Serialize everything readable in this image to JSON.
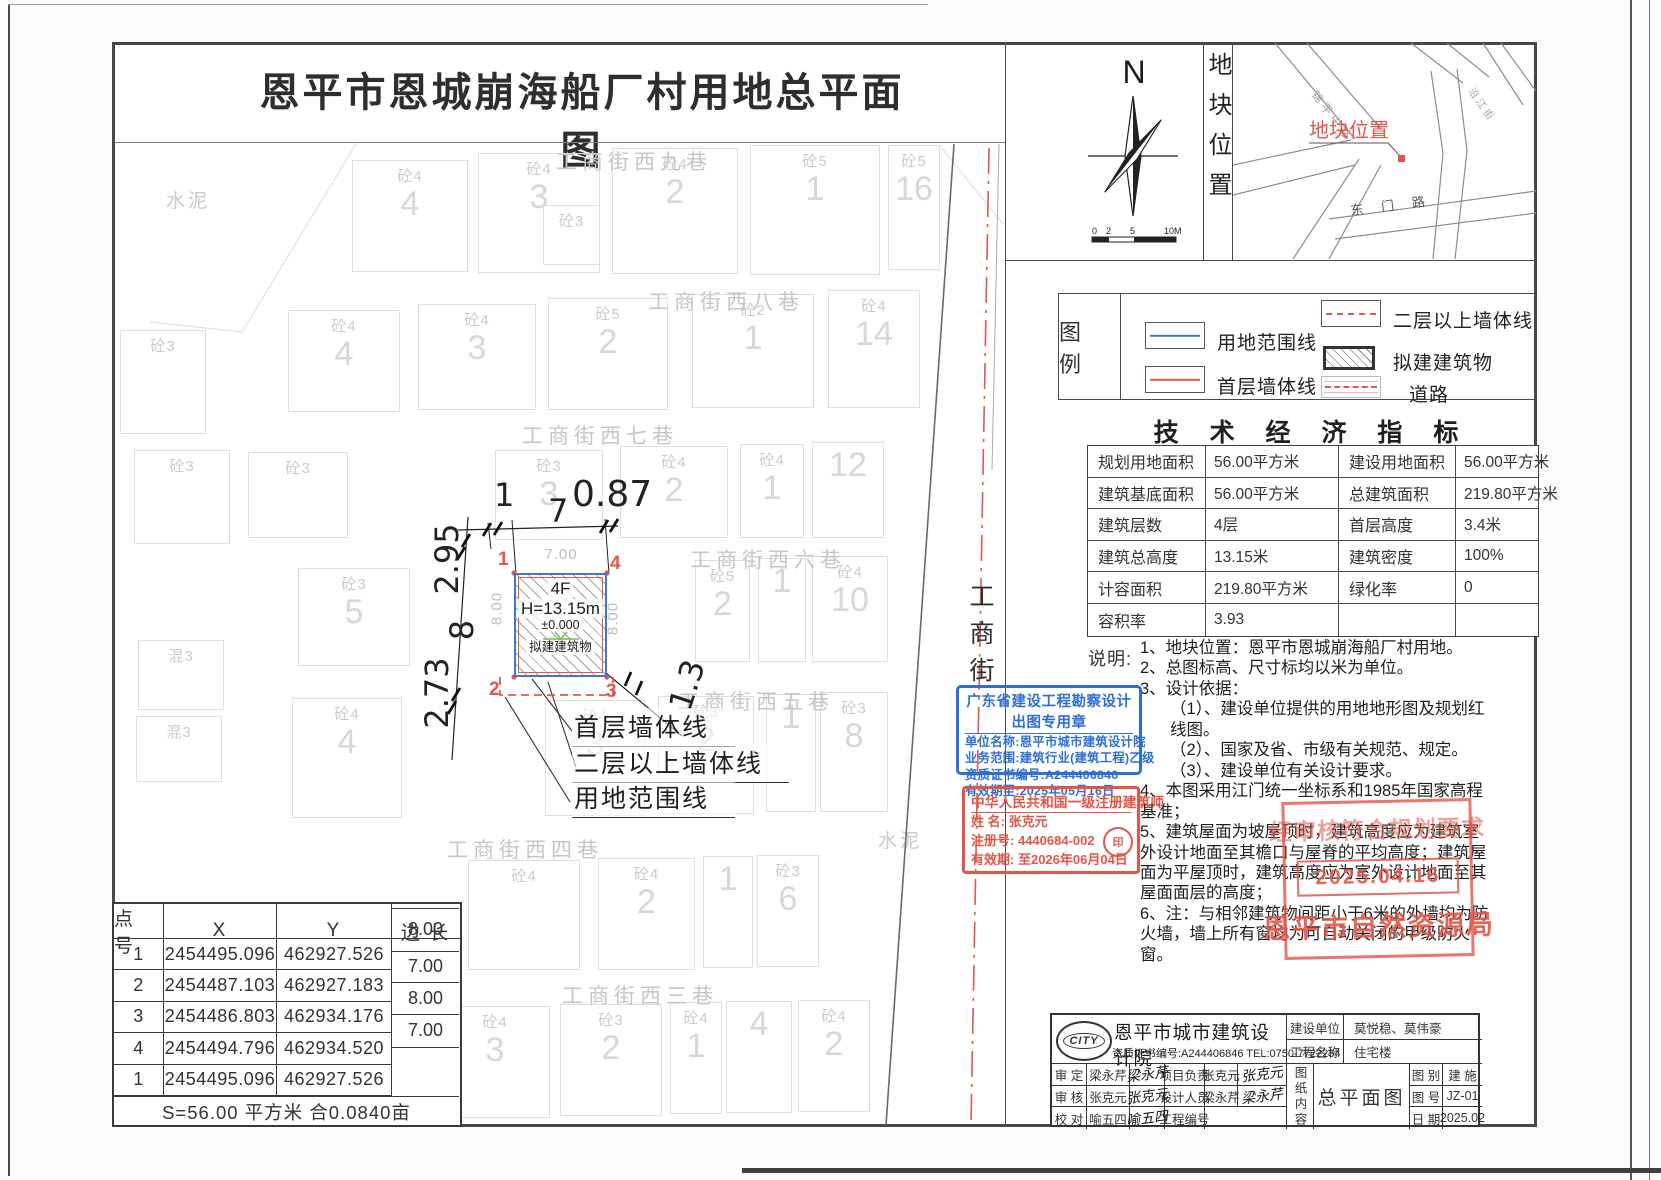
{
  "title": "恩平市恩城崩海船厂村用地总平面图",
  "compass": {
    "north": "N",
    "scale_labels": [
      "0",
      "2",
      "5",
      "10M"
    ]
  },
  "location": {
    "panel_label": "地块位置",
    "marker_text": "地块位置",
    "road_labels": [
      "锦平中路",
      "东门路",
      "沿江街"
    ]
  },
  "legend": {
    "heading": "图 例",
    "items": [
      {
        "key": "boundary-line",
        "label": "用地范围线"
      },
      {
        "key": "first-floor-wall-line",
        "label": "首层墙体线"
      },
      {
        "key": "upper-floor-wall-line",
        "label": "二层以上墙体线"
      },
      {
        "key": "proposed-building",
        "label": "拟建建筑物"
      },
      {
        "key": "road",
        "label": "道路"
      }
    ]
  },
  "indicators": {
    "heading": "技 术 经 济 指 标",
    "rows": [
      [
        "规划用地面积",
        "56.00平方米",
        "建设用地面积",
        "56.00平方米"
      ],
      [
        "建筑基底面积",
        "56.00平方米",
        "总建筑面积",
        "219.80平方米"
      ],
      [
        "建筑层数",
        "4层",
        "首层高度",
        "3.4米"
      ],
      [
        "建筑总高度",
        "13.15米",
        "建筑密度",
        "100%"
      ],
      [
        "计容面积",
        "219.80平方米",
        "绿化率",
        "0"
      ],
      [
        "容积率",
        "3.93",
        "",
        ""
      ]
    ]
  },
  "notes": {
    "label": "说明:",
    "lines": [
      {
        "text": "1、地块位置：恩平市恩城崩海船厂村用地。",
        "indent": 0
      },
      {
        "text": "2、总图标高、尺寸标均以米为单位。",
        "indent": 0
      },
      {
        "text": "3、设计依据：",
        "indent": 0
      },
      {
        "text": "（1）、建设单位提供的用地地形图及规划红线图。",
        "indent": 1
      },
      {
        "text": "（2）、国家及省、市级有关规范、规定。",
        "indent": 1
      },
      {
        "text": "（3）、建设单位有关设计要求。",
        "indent": 1
      },
      {
        "text": "4、本图采用江门统一坐标系和1985年国家高程基准；",
        "indent": 0
      },
      {
        "text": "5、建筑屋面为坡屋顶时，建筑高度应为建筑室外设计地面至其檐口与屋脊的平均高度；建筑屋面为平屋顶时，建筑高度应为室外设计地面至其屋面面层的高度；",
        "indent": 0
      },
      {
        "text": "6、注：与相邻建筑物间距小于6米的外墙均为防火墙，墙上所有窗均为可自动关闭的甲级防火窗。",
        "indent": 0
      }
    ]
  },
  "stamps": {
    "design": {
      "title": "广东省建设工程勘察设计出图专用章",
      "rows": [
        "单位名称:恩平市城市建筑设计院",
        "业务范围:建筑行业(建筑工程)乙级",
        "资质证书编号:A244406846",
        "有效期至:2025年05月16日"
      ]
    },
    "architect": {
      "title": "中华人民共和国一级注册建筑师",
      "name_label": "姓  名:",
      "name": "张克元",
      "reg_label": "注册号:",
      "reg": "4440684-002",
      "valid_label": "有效期:",
      "valid": "至2026年06月04日",
      "seal": "印"
    },
    "approval": {
      "line1": "经审核符合规划要求",
      "date": "2025.04.16",
      "agency": "恩平市自然资源局"
    }
  },
  "titleblock": {
    "logo_text": "CITY",
    "company": "恩平市城市建筑设计院",
    "credential": "资质证书编号:A244406846 TEL:0750-7722234",
    "client_label": "建设单位",
    "client": "莫悦稳、莫伟豪",
    "project_label": "工程名称",
    "project": "住宅楼",
    "content_label": "图纸内容",
    "content": "总平面图",
    "left_rows": [
      {
        "l1": "审 定",
        "v1": "梁永芹",
        "s1": "梁永芹",
        "l2": "项目负责",
        "v2": "张克元",
        "s2": "张克元"
      },
      {
        "l1": "审 核",
        "v1": "张克元",
        "s1": "张克元",
        "l2": "设计人员",
        "v2": "梁永芹",
        "s2": "梁永芹"
      },
      {
        "l1": "校 对",
        "v1": "喻五四",
        "s1": "喻五四",
        "l2": "工程编号",
        "v2": "",
        "s2": ""
      }
    ],
    "meta": [
      {
        "label": "图 别",
        "value": "建 施"
      },
      {
        "label": "图 号",
        "value": "JZ-01"
      },
      {
        "label": "日 期",
        "value": "2025.02"
      }
    ]
  },
  "coord_table": {
    "headers": [
      "点 号",
      "X",
      "Y",
      "边 长"
    ],
    "rows": [
      {
        "p": "1",
        "x": "2454495.096",
        "y": "462927.526"
      },
      {
        "p": "2",
        "x": "2454487.103",
        "y": "462927.183"
      },
      {
        "p": "3",
        "x": "2454486.803",
        "y": "462934.176"
      },
      {
        "p": "4",
        "x": "2454494.796",
        "y": "462934.520"
      },
      {
        "p": "1",
        "x": "2454495.096",
        "y": "462927.526"
      }
    ],
    "edges": [
      "8.00",
      "7.00",
      "8.00",
      "7.00"
    ],
    "footer": "S=56.00 平方米 合0.0840亩"
  },
  "site": {
    "building": {
      "floors": "4F",
      "height": "H=13.15m",
      "level": "±0.000",
      "name": "拟建建筑物"
    },
    "corners": {
      "tl": "1",
      "tr": "4",
      "bl": "2",
      "br": "3"
    },
    "dims": {
      "top_left": "1",
      "top": "7",
      "top_right": "0.87",
      "left_upper": "2.95",
      "left_mid": "8",
      "left_lower": "2.73",
      "right_lower": "1.3",
      "inner_top": "7.00",
      "inner_left": "8.00",
      "inner_right": "8.00"
    },
    "callouts": [
      "首层墙体线",
      "二层以上墙体线",
      "用地范围线"
    ]
  },
  "map": {
    "street_vertical": "工商街",
    "streets": [
      {
        "label": "工商街西九巷",
        "x": 556,
        "y": 146
      },
      {
        "label": "工商街西八巷",
        "x": 648,
        "y": 286
      },
      {
        "label": "工商街西七巷",
        "x": 522,
        "y": 420
      },
      {
        "label": "工商街西六巷",
        "x": 690,
        "y": 544
      },
      {
        "label": "工商街西五巷",
        "x": 678,
        "y": 686
      },
      {
        "label": "工商街西四巷",
        "x": 447,
        "y": 834
      },
      {
        "label": "工商街西三巷",
        "x": 562,
        "y": 980
      }
    ],
    "area_labels": [
      {
        "text": "水泥",
        "x": 166,
        "y": 186
      },
      {
        "text": "水泥",
        "x": 878,
        "y": 826
      }
    ],
    "parcels": [
      {
        "x": 352,
        "y": 160,
        "w": 116,
        "h": 112,
        "m": "砼4",
        "n": "4"
      },
      {
        "x": 478,
        "y": 153,
        "w": 122,
        "h": 120,
        "m": "砼4",
        "n": "3"
      },
      {
        "x": 543,
        "y": 205,
        "w": 57,
        "h": 60,
        "m": "砼3",
        "n": ""
      },
      {
        "x": 612,
        "y": 148,
        "w": 126,
        "h": 126,
        "m": "砼4",
        "n": "2"
      },
      {
        "x": 750,
        "y": 145,
        "w": 130,
        "h": 130,
        "m": "砼5",
        "n": "1"
      },
      {
        "x": 888,
        "y": 145,
        "w": 52,
        "h": 125,
        "m": "砼5",
        "n": "16"
      },
      {
        "x": 288,
        "y": 310,
        "w": 112,
        "h": 102,
        "m": "砼4",
        "n": "4"
      },
      {
        "x": 418,
        "y": 304,
        "w": 118,
        "h": 106,
        "m": "砼4",
        "n": "3"
      },
      {
        "x": 548,
        "y": 298,
        "w": 120,
        "h": 112,
        "m": "砼5",
        "n": "2"
      },
      {
        "x": 692,
        "y": 294,
        "w": 122,
        "h": 114,
        "m": "砼2",
        "n": "1"
      },
      {
        "x": 828,
        "y": 290,
        "w": 92,
        "h": 118,
        "m": "砼4",
        "n": "14"
      },
      {
        "x": 248,
        "y": 452,
        "w": 100,
        "h": 86,
        "m": "砼3",
        "n": ""
      },
      {
        "x": 495,
        "y": 450,
        "w": 108,
        "h": 90,
        "m": "砼3",
        "n": "3"
      },
      {
        "x": 620,
        "y": 446,
        "w": 108,
        "h": 92,
        "m": "砼4",
        "n": "2"
      },
      {
        "x": 740,
        "y": 444,
        "w": 64,
        "h": 94,
        "m": "砼4",
        "n": "1"
      },
      {
        "x": 812,
        "y": 442,
        "w": 72,
        "h": 96,
        "m": "",
        "n": "12"
      },
      {
        "x": 298,
        "y": 568,
        "w": 112,
        "h": 98,
        "m": "砼3",
        "n": "5"
      },
      {
        "x": 695,
        "y": 560,
        "w": 55,
        "h": 102,
        "m": "砼5",
        "n": "2"
      },
      {
        "x": 758,
        "y": 558,
        "w": 48,
        "h": 104,
        "m": "",
        "n": "1"
      },
      {
        "x": 812,
        "y": 556,
        "w": 76,
        "h": 106,
        "m": "砼4",
        "n": "10"
      },
      {
        "x": 292,
        "y": 698,
        "w": 110,
        "h": 120,
        "m": "砼4",
        "n": "4"
      },
      {
        "x": 545,
        "y": 700,
        "w": 100,
        "h": 116,
        "m": "砼4",
        "n": "3"
      },
      {
        "x": 658,
        "y": 696,
        "w": 96,
        "h": 118,
        "m": "砼3",
        "n": "2"
      },
      {
        "x": 766,
        "y": 694,
        "w": 50,
        "h": 118,
        "m": "",
        "n": "1"
      },
      {
        "x": 820,
        "y": 692,
        "w": 68,
        "h": 120,
        "m": "砼3",
        "n": "8"
      },
      {
        "x": 468,
        "y": 860,
        "w": 112,
        "h": 110,
        "m": "砼4",
        "n": ""
      },
      {
        "x": 598,
        "y": 858,
        "w": 97,
        "h": 112,
        "m": "砼4",
        "n": "2"
      },
      {
        "x": 703,
        "y": 856,
        "w": 50,
        "h": 112,
        "m": "",
        "n": "1"
      },
      {
        "x": 757,
        "y": 855,
        "w": 62,
        "h": 112,
        "m": "砼3",
        "n": "6"
      },
      {
        "x": 440,
        "y": 1006,
        "w": 110,
        "h": 112,
        "m": "砼4",
        "n": "3"
      },
      {
        "x": 560,
        "y": 1004,
        "w": 102,
        "h": 112,
        "m": "砼3",
        "n": "2"
      },
      {
        "x": 670,
        "y": 1002,
        "w": 52,
        "h": 112,
        "m": "砼4",
        "n": "1"
      },
      {
        "x": 726,
        "y": 1001,
        "w": 66,
        "h": 112,
        "m": "",
        "n": "4"
      },
      {
        "x": 798,
        "y": 1000,
        "w": 72,
        "h": 112,
        "m": "砼4",
        "n": "2"
      },
      {
        "x": 120,
        "y": 330,
        "w": 86,
        "h": 104,
        "m": "砼3",
        "n": ""
      },
      {
        "x": 134,
        "y": 450,
        "w": 96,
        "h": 94,
        "m": "砼3",
        "n": ""
      },
      {
        "x": 138,
        "y": 640,
        "w": 86,
        "h": 70,
        "m": "混3",
        "n": ""
      },
      {
        "x": 136,
        "y": 716,
        "w": 86,
        "h": 66,
        "m": "混3",
        "n": ""
      }
    ]
  },
  "colors": {
    "boundary": "#3f78c6",
    "wall": "#e0574b",
    "stamp_blue": "#2f6fd0",
    "stamp_red": "#e2564a",
    "hatch": "#a3a3a3",
    "level_green": "#6abf4b"
  }
}
